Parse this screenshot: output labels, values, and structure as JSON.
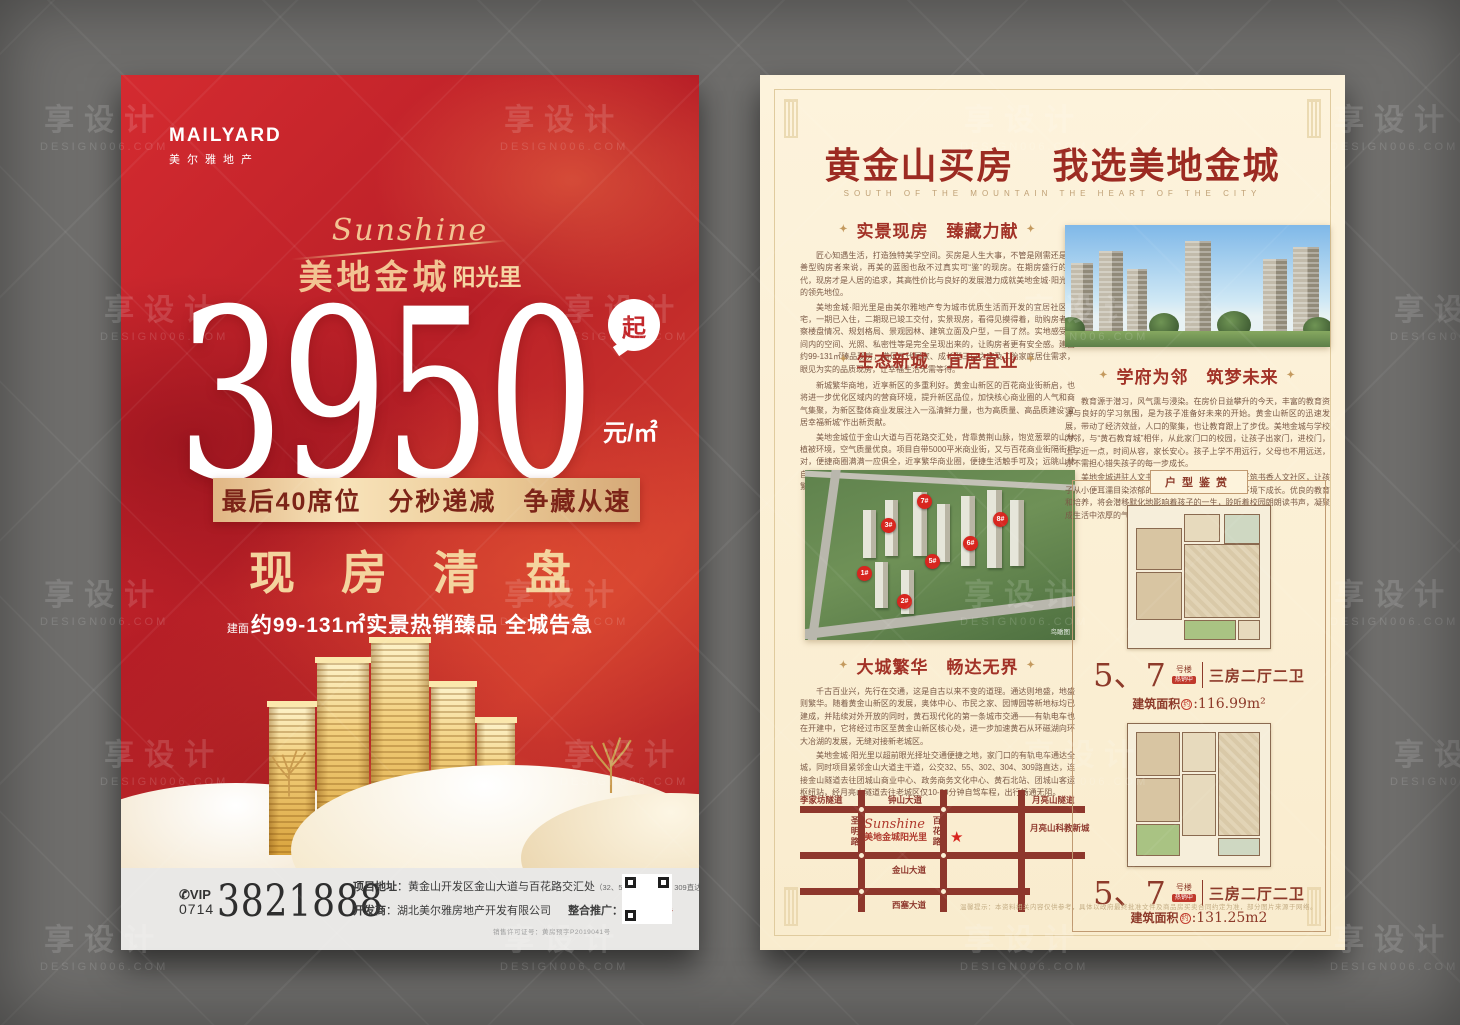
{
  "watermark": {
    "cn": "享设计",
    "en": "DESIGN006.COM"
  },
  "colors": {
    "red_bg": "#c2242a",
    "gold": "#f2c392",
    "cream": "#fdf3dc",
    "dark_red_text": "#9c2b22"
  },
  "front": {
    "brand": {
      "name": "MAILYARD",
      "cn": "美尔雅地产"
    },
    "logo": {
      "script": "Sunshine",
      "cn": "美地金城",
      "sub": "阳光里"
    },
    "price": {
      "value": "3950",
      "qi": "起",
      "unit": "元/㎡"
    },
    "banner": "最后40席位　分秒递减　争藏从速",
    "slogan": "现房清盘",
    "tagline_prefix": "建面",
    "tagline": "约99-131㎡实景热销臻品 全城告急",
    "footer": {
      "phone_icon": "✆",
      "vip": "VIP",
      "area_code": "0714",
      "phone": "3821888",
      "address_label": "项目地址",
      "address": "：黄金山开发区金山大道与百花路交汇处",
      "address_note": "（32、55、302、304、309直达）",
      "developer_label": "开发商",
      "developer": "：湖北美尔雅房地产开发有限公司",
      "agency_label": "整合推广：",
      "agency_name": "山水广告",
      "license": "销售许可证号：黄房预字P2019041号"
    }
  },
  "back": {
    "title": "黄金山买房　我选美地金城",
    "subtitle": "SOUTH OF THE MOUNTAIN THE HEART OF THE CITY",
    "diamond": "✦",
    "sections": [
      {
        "title": "实景现房　臻藏力献",
        "p1": "匠心知遇生活，打造独特美学空间。买房是人生大事，不管是刚需还是改善型购房者来说，再美的蓝图也敌不过真实可“鉴”的现房。在期房盛行的时代，现房才是人居的追求，其高性价比与良好的发展潜力成就美地金城·阳光里的领先地位。",
        "p2": "美地金城·阳光里是由美尔雅地产专为城市优质生活而开发的宜居社区美宅，一期已入住，二期现已竣工交付，实景现房，看得见摸得着，助购房者考察楼盘情况、规划格局、景观园林、建筑立面及户型，一目了然。实地感受房间内的空间、光照、私密性等是完全呈现出来的，让购房者更有安全感。建面约99-131㎡臻品现房，满足三代居家、成长型三口之家及二胎家庭居住需求，眼见为实的品质现房，让幸福生活无需等待。"
      },
      {
        "title": "生态新城　宜居宜业",
        "p1": "新城繁华商地，近享新区的多重利好。黄金山新区的百花商业街新启，也将进一步优化区域内的营商环境，提升新区品位，加快核心商业圈的人气和商气集聚，为新区整体商业发展注入一泓清鲜力量，也为高质量、高品质建设“宜居幸福新城”作出新贡献。",
        "p2": "美地金城位于金山大道与百花路交汇处，背靠黄荆山脉，饱览葱翠的山林植被环境，空气质量优良。项目自带5000平米商业街，又与百花商业街隔街相对，便捷商圈满满一应俱全，近享繁华商业圈，便捷生活触手可及；远眺山林自然风韵，享受自然惬意的绿色居家生活。安家于此遇见美好生活，邂逅一城繁华，安享小区惬意品质慢生活，让一切皆有可能。"
      },
      {
        "title": "学府为邻　筑梦未来",
        "p1": "教育源于潜习，风气熏与浸染。在房价日益攀升的今天，丰富的教育资源与良好的学习氛围，是为孩子准备好未来的开始。黄金山新区的迅速发展，带动了经济效益，人口的聚集，也让教育跟上了步伐。美地金城与学校为邻，与“黄石教育城”相伴，从此家门口的校园，让孩子出家门，进校门，上学近一点，时间从容，家长安心。孩子上学不用远行，父母也不用远送，亦不需担心错失孩子的每一步成长。",
        "p2": "美地金城进驻人文书香璀璨之地，荟萃学府，匠筑书香人文社区，让孩子从小便耳濡目染浓郁的文化气息，在良好的教育环境下成长。优良的教育和培养，将会潜移默化地影响着孩子的一生，聆听着校园朗朗读书声，凝聚成生活中浓厚的气息，让孩子欢乐前行，走向辉煌未来！"
      },
      {
        "title": "大城繁华　畅达无界",
        "p1": "千古百业兴，先行在交通，这是自古以来不变的道理。通达则地盛，地盛则繁华。随着黄金山新区的发展，奥体中心、市民之家、园博园等新地标均已建成，并陆续对外开放的同时，黄石现代化的第一条城市交通——有轨电车也在开建中，它将经过市区至黄金山新区核心处，进一步加速黄石从环磁湖向环大冶湖的发展，无缝对接新老城区。",
        "p2": "美地金城·阳光里以超前眼光择址交通便捷之地，家门口的有轨电车通达全城，同时项目紧邻金山大道主干道，公交32、55、302、304、309路直达，连接金山隧道去往团城山商业中心、政务商务文化中心、黄石北站、团城山客运枢纽站，经月亮山隧道去往老城区仅10-20分钟自驾车程，出行畅通无阻。"
      }
    ],
    "aerial": {
      "caption": "鸟瞰图",
      "badges": [
        "7#",
        "3#",
        "8#",
        "6#",
        "5#",
        "1#",
        "2#"
      ]
    },
    "map": {
      "labels": {
        "tunnel_left": "李家坊隧道",
        "road_top": "钟山大道",
        "tunnel_right": "月亮山隧道",
        "district_right": "月亮山科教新城",
        "road_v1": "圣明路",
        "road_v2": "百花路",
        "road_mid": "金山大道",
        "road_bottom": "西塞大道",
        "project_script": "Sunshine",
        "project_cn": "美地金城阳光里",
        "star": "★"
      }
    },
    "plans": {
      "panel_title": "户型鉴赏",
      "items": [
        {
          "building": "5、7",
          "suffix": "号楼",
          "tag": "热销中",
          "type": "三房二厅二卫",
          "area_label": "建筑面积",
          "approx": "约",
          "area": ":116.99m²"
        },
        {
          "building": "5、7",
          "suffix": "号楼",
          "tag": "热销中",
          "type": "三房二厅二卫",
          "area_label": "建筑面积",
          "approx": "约",
          "area": ":131.25m2"
        }
      ]
    },
    "disclaimer": "温馨提示：本资料相关内容仅供参考，具体以政府最终批准文件及商品房买卖合同约定为准，部分图片来源于网络。"
  }
}
